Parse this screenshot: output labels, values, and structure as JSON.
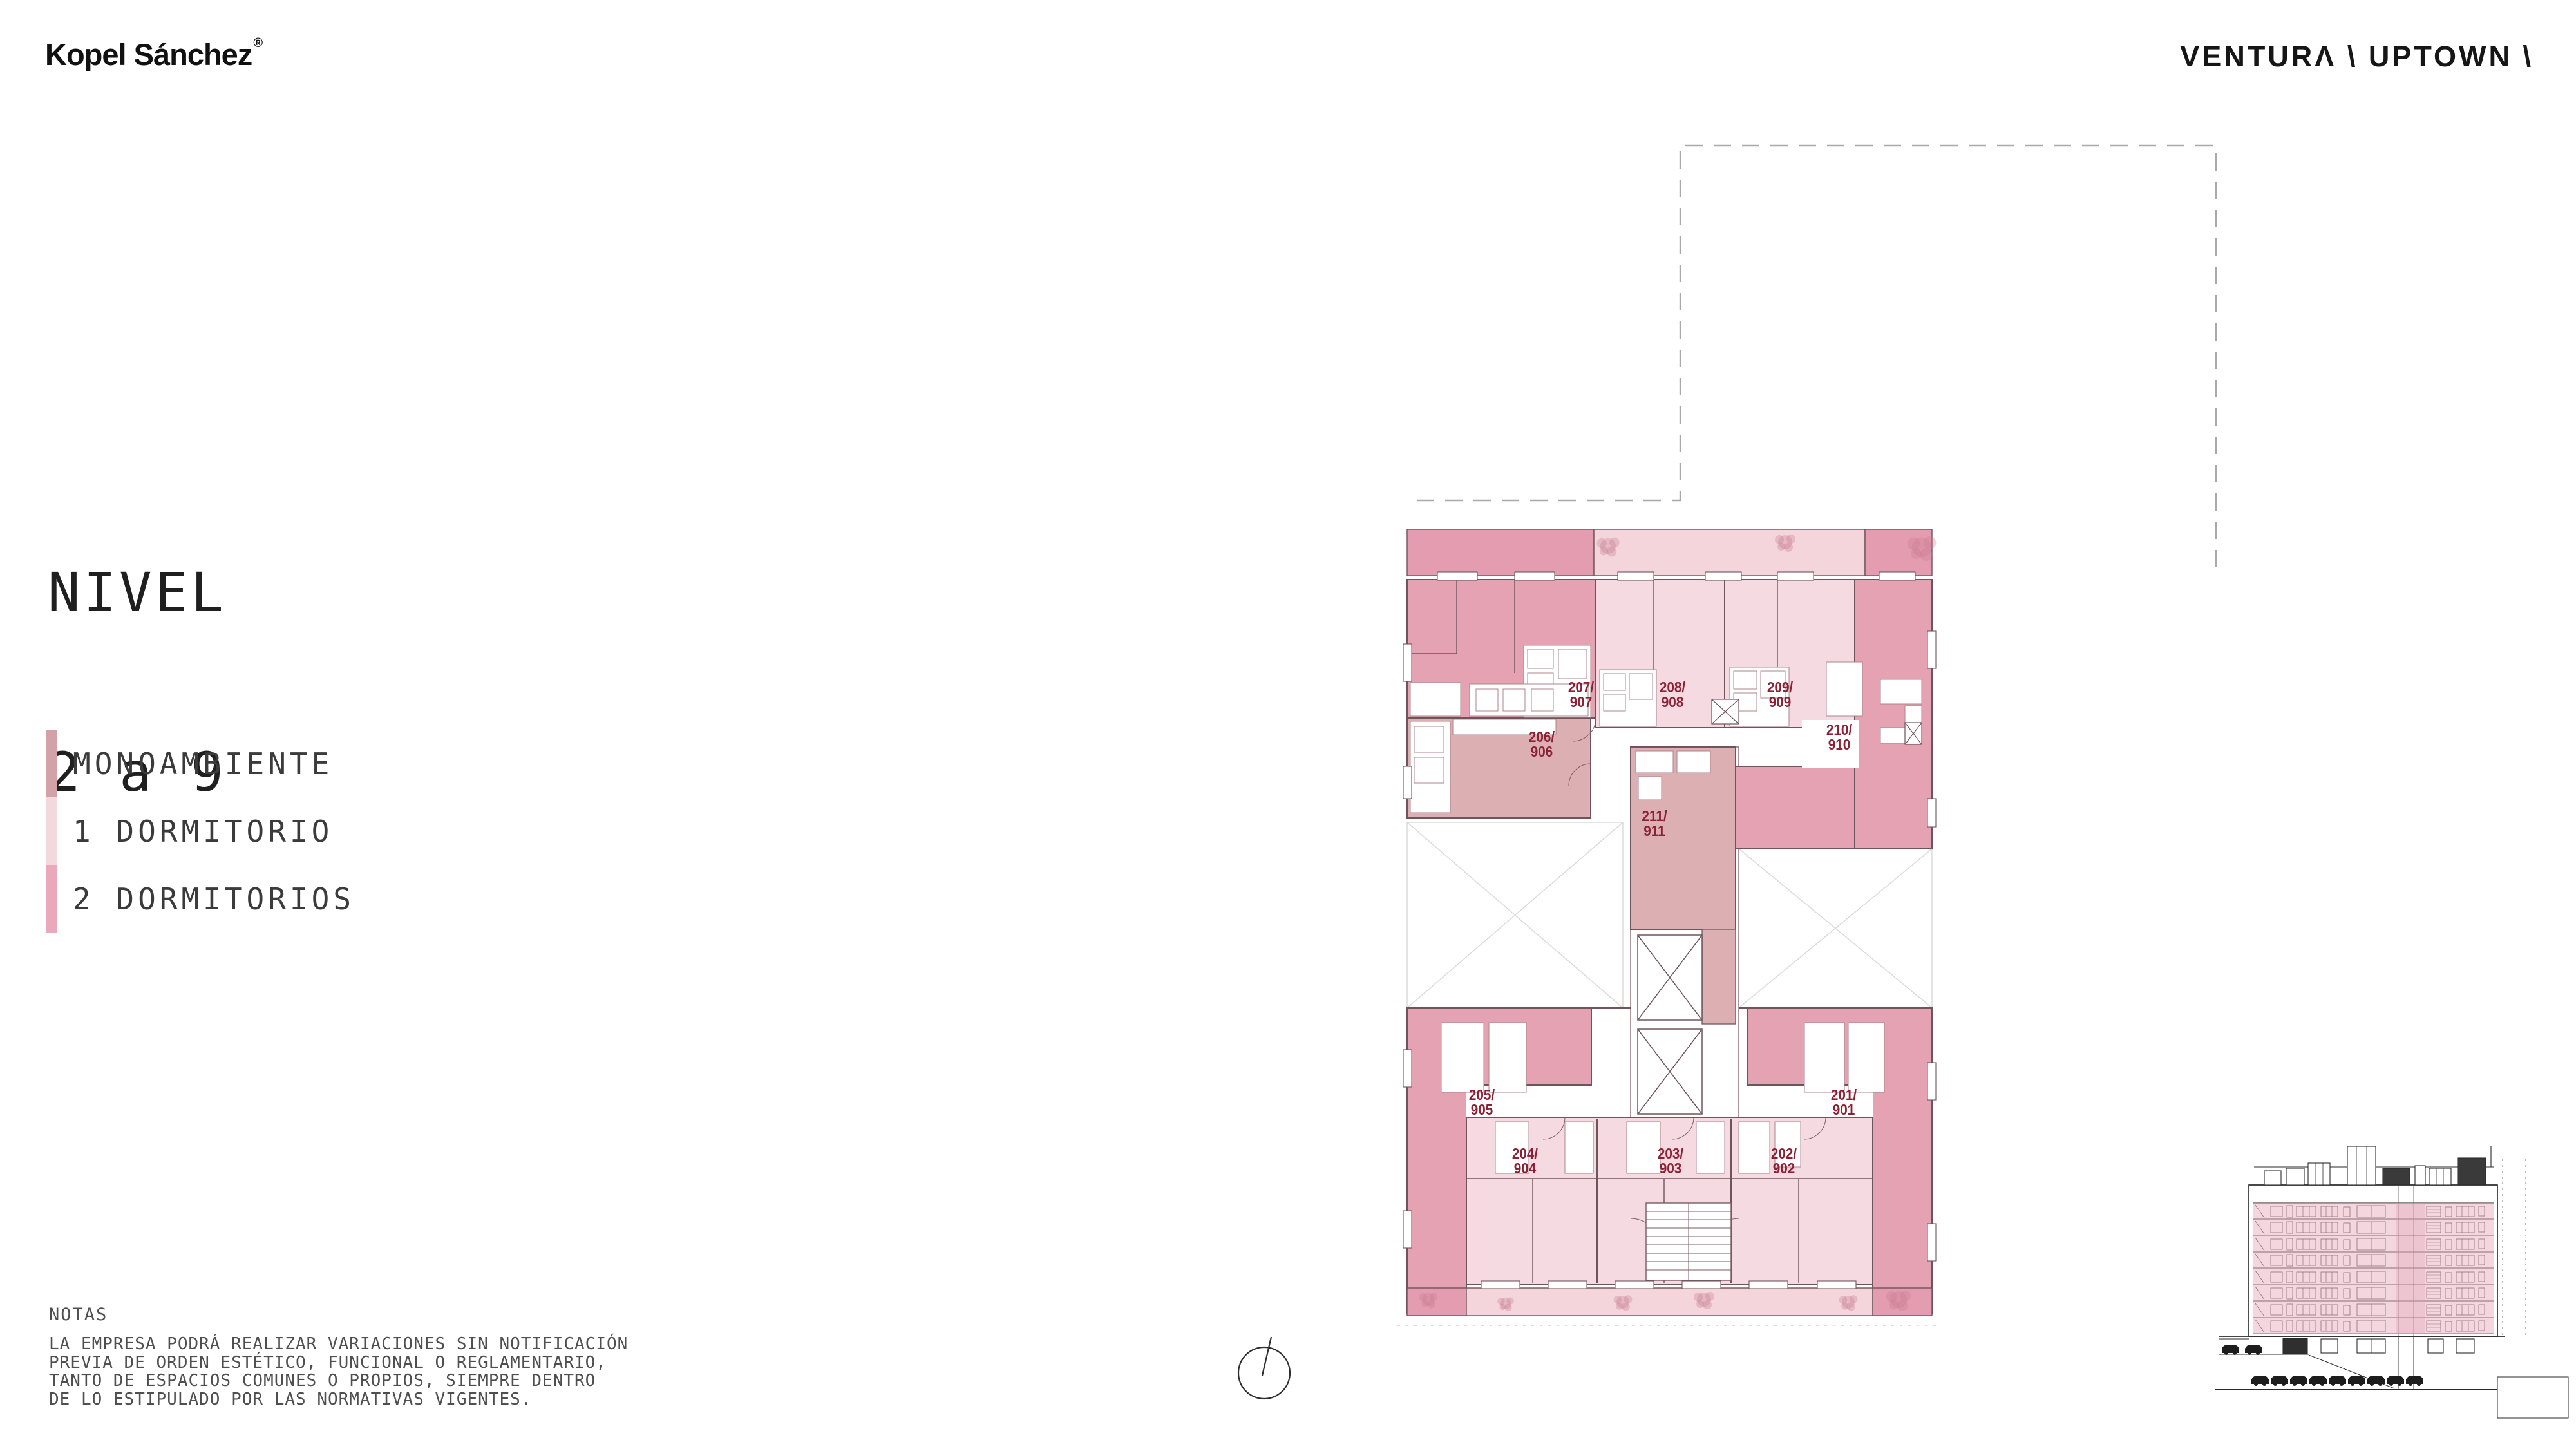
{
  "header": {
    "logo": "Kopel Sánchez",
    "logo_reg": "®",
    "brand": "VENTURΛ \\ UPTOWN \\"
  },
  "title": {
    "line1": "NIVEL",
    "line2": "2 a 9"
  },
  "legend": {
    "items": [
      {
        "label": "MONOAMBIENTE",
        "color": "#d2a2a8",
        "type": "monoambiente"
      },
      {
        "label": "1 DORMITORIO",
        "color": "#f3d8dd",
        "type": "1-dormitorio"
      },
      {
        "label": "2 DORMITORIOS",
        "color": "#e9a9bb",
        "type": "2-dormitorios"
      }
    ]
  },
  "notes": {
    "heading": "NOTAS",
    "lines": [
      "LA EMPRESA PODRÁ REALIZAR VARIACIONES SIN NOTIFICACIÓN",
      "PREVIA DE ORDEN ESTÉTICO, FUNCIONAL O REGLAMENTARIO,",
      "TANTO DE ESPACIOS COMUNES O PROPIOS, SIEMPRE DENTRO",
      "DE LO ESTIPULADO POR LAS NORMATIVAS VIGENTES."
    ]
  },
  "plan": {
    "units": [
      {
        "line1": "201/",
        "line2": "901",
        "type": "2-dormitorios"
      },
      {
        "line1": "202/",
        "line2": "902",
        "type": "1-dormitorio"
      },
      {
        "line1": "203/",
        "line2": "903",
        "type": "1-dormitorio"
      },
      {
        "line1": "204/",
        "line2": "904",
        "type": "1-dormitorio"
      },
      {
        "line1": "205/",
        "line2": "905",
        "type": "2-dormitorios"
      },
      {
        "line1": "206/",
        "line2": "906",
        "type": "monoambiente"
      },
      {
        "line1": "207/",
        "line2": "907",
        "type": "2-dormitorios"
      },
      {
        "line1": "208/",
        "line2": "908",
        "type": "1-dormitorio"
      },
      {
        "line1": "209/",
        "line2": "909",
        "type": "1-dormitorio"
      },
      {
        "line1": "210/",
        "line2": "910",
        "type": "2-dormitorios"
      },
      {
        "line1": "211/",
        "line2": "911",
        "type": "monoambiente"
      }
    ]
  },
  "colors": {
    "plan_dark_pink": "#e5a2b3",
    "plan_light_pink": "#f5dbe1",
    "plan_mauve": "#dcafb3",
    "balcony_strip": "#f3d5db",
    "unit_label": "#8c2135",
    "section_overlay": "#e29eb1"
  },
  "icons": {
    "north_compass": "compass-circle-with-north-line"
  }
}
